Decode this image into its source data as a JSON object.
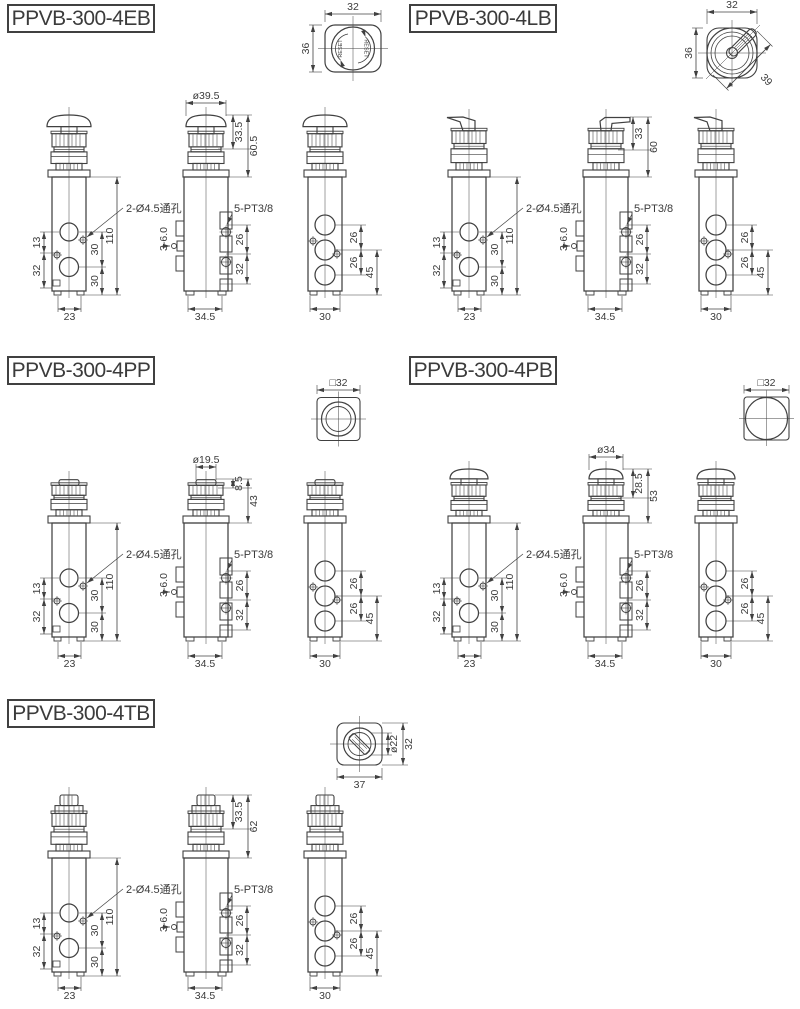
{
  "page": {
    "background": "#ffffff",
    "ink": "#404040"
  },
  "groups": {
    "g4EB": {
      "label": "PPVB-300-4EB",
      "cap": "ø39.5",
      "h1": "33.5",
      "h2": "60.5",
      "top": {
        "w": "32",
        "h": "36",
        "reset_l": "RESET",
        "reset_r": "RESET"
      }
    },
    "g4LB": {
      "label": "PPVB-300-4LB",
      "h1": "33",
      "h2": "60",
      "top": {
        "w": "32",
        "h": "36",
        "diag": "39"
      }
    },
    "g4PP": {
      "label": "PPVB-300-4PP",
      "cap": "ø19.5",
      "h1": "8.5",
      "h2": "43",
      "top": {
        "sq": "□32"
      }
    },
    "g4PB": {
      "label": "PPVB-300-4PB",
      "cap": "ø34",
      "h1": "28.5",
      "h2": "53",
      "top": {
        "sq": "□32"
      }
    },
    "g4TB": {
      "label": "PPVB-300-4TB",
      "h1": "33.5",
      "h2": "62",
      "top": {
        "d": "ø22",
        "h": "32",
        "w": "37"
      }
    }
  },
  "front_view": {
    "hole_pitch_upper": "13",
    "hole_pitch_lower": "32",
    "port_pitch_a": "30",
    "port_pitch_b": "30",
    "body_height": "110",
    "width": "23",
    "callout": "2-Ø4.5通孔"
  },
  "side_view": {
    "nipple": "3-6.0",
    "callout": "5-PT3/8",
    "port_pitch": "26",
    "port_pitch_lower": "32",
    "width": "34.5"
  },
  "back_view": {
    "pitch_a": "26",
    "pitch_b": "26",
    "pitch_total": "45",
    "width": "30"
  }
}
